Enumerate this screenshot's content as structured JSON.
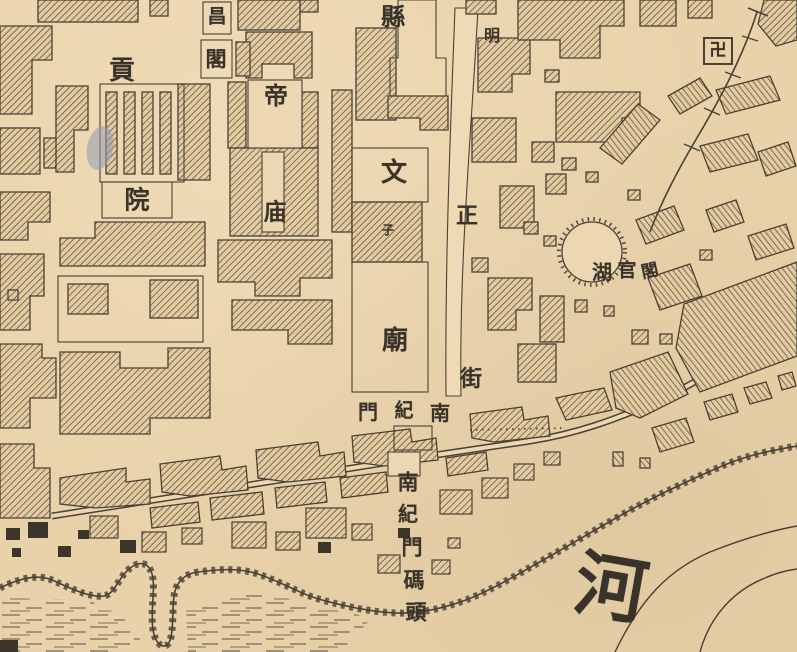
{
  "map": {
    "description_labels_note": "all visible text on the scanned map",
    "colors": {
      "paper": "#e9d2aa",
      "paper_light": "#f0ddbb",
      "ink": "#4a4134",
      "stain_blue": "#8f9cb3"
    },
    "labels": [
      {
        "name": "label-gongyuan-gong",
        "text": "貢",
        "x": 122,
        "y": 71,
        "size": 26
      },
      {
        "name": "label-gongyuan-yuan",
        "text": "院",
        "x": 137,
        "y": 200,
        "size": 25
      },
      {
        "name": "label-wenchangge-chang",
        "text": "昌",
        "x": 217,
        "y": 17,
        "size": 19
      },
      {
        "name": "label-wenchangge-ge",
        "text": "閣",
        "x": 216,
        "y": 59,
        "size": 21
      },
      {
        "name": "label-dimiao-di",
        "text": "帝",
        "x": 276,
        "y": 96,
        "size": 24
      },
      {
        "name": "label-dimiao-miao",
        "text": "庙",
        "x": 275,
        "y": 212,
        "size": 23
      },
      {
        "name": "label-xian",
        "text": "縣",
        "x": 393,
        "y": 17,
        "size": 24
      },
      {
        "name": "label-street-ming",
        "text": "明",
        "x": 492,
        "y": 36,
        "size": 16
      },
      {
        "name": "label-wenmiao-wen",
        "text": "文",
        "x": 394,
        "y": 173,
        "size": 26
      },
      {
        "name": "label-wenmiao-zi",
        "text": "子",
        "x": 388,
        "y": 230,
        "size": 12
      },
      {
        "name": "label-wenmiao-miao",
        "text": "廟",
        "x": 395,
        "y": 341,
        "size": 26
      },
      {
        "name": "label-street-zheng",
        "text": "正",
        "x": 467,
        "y": 216,
        "size": 22
      },
      {
        "name": "label-street-jie",
        "text": "街",
        "x": 471,
        "y": 379,
        "size": 22
      },
      {
        "name": "label-nanjimen-men",
        "text": "門",
        "x": 368,
        "y": 412,
        "size": 20
      },
      {
        "name": "label-nanjimen-ji",
        "text": "紀",
        "x": 404,
        "y": 411,
        "size": 19
      },
      {
        "name": "label-nanjimen-nan",
        "text": "南",
        "x": 440,
        "y": 413,
        "size": 20
      },
      {
        "name": "label-lake-hu",
        "text": "湖",
        "x": 602,
        "y": 272,
        "size": 20
      },
      {
        "name": "label-lake-guan",
        "text": "官",
        "x": 627,
        "y": 271,
        "size": 19
      },
      {
        "name": "label-lake-ge",
        "text": "閣",
        "x": 650,
        "y": 272,
        "size": 17,
        "rotate": -12
      },
      {
        "name": "label-wharf-nan",
        "text": "南",
        "x": 408,
        "y": 482,
        "size": 21
      },
      {
        "name": "label-wharf-ji",
        "text": "紀",
        "x": 408,
        "y": 514,
        "size": 20
      },
      {
        "name": "label-wharf-men",
        "text": "門",
        "x": 412,
        "y": 547,
        "size": 21
      },
      {
        "name": "label-wharf-ma",
        "text": "碼",
        "x": 414,
        "y": 580,
        "size": 21
      },
      {
        "name": "label-wharf-tou",
        "text": "頭",
        "x": 416,
        "y": 612,
        "size": 21
      },
      {
        "name": "label-river-he",
        "text": "河",
        "x": 611,
        "y": 588,
        "size": 72,
        "rotate": 10
      },
      {
        "name": "temple-swastika-symbol",
        "text": "卍",
        "x": 718,
        "y": 51,
        "size": 17
      }
    ]
  }
}
